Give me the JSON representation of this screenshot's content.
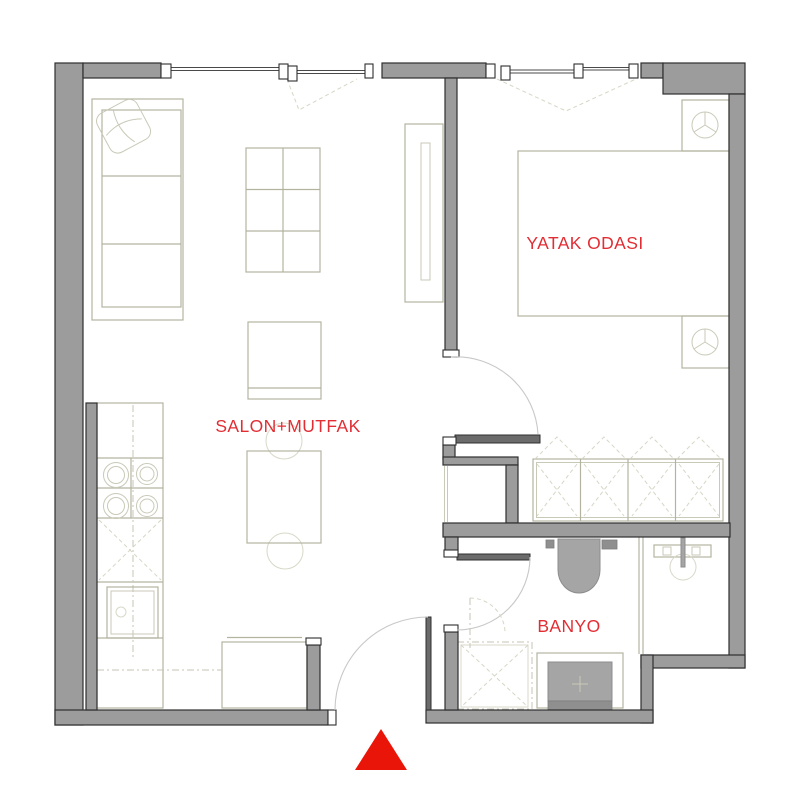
{
  "floor_plan": {
    "labels": {
      "bedroom": "YATAK ODASI",
      "living_kitchen": "SALON+MUTFAK",
      "bathroom": "BANYO"
    },
    "colors": {
      "wall_fill": "#9c9c9c",
      "wall_outline": "#2f2f2f",
      "furniture_stroke": "#b3b3a0",
      "furniture_faint": "#d8d8c8",
      "label_red": "#e12e34",
      "entrance_triangle_red": "#ea1509",
      "door_leaf_gray": "#6b6b6b"
    },
    "icons": {
      "entrance_marker": "red-triangle-up",
      "bedroom_lamp": "circle-three-spokes",
      "shower_drain": "plus-mark"
    },
    "furniture": [
      "sofa",
      "pillow",
      "shelf-table",
      "tv-cabinet",
      "armchair",
      "dining-table",
      "dining-chairs",
      "kitchen-counter",
      "stove-burners",
      "oven",
      "bed",
      "nightstands",
      "wardrobe",
      "toilet",
      "sink",
      "shower-tray",
      "washing-machine"
    ]
  }
}
